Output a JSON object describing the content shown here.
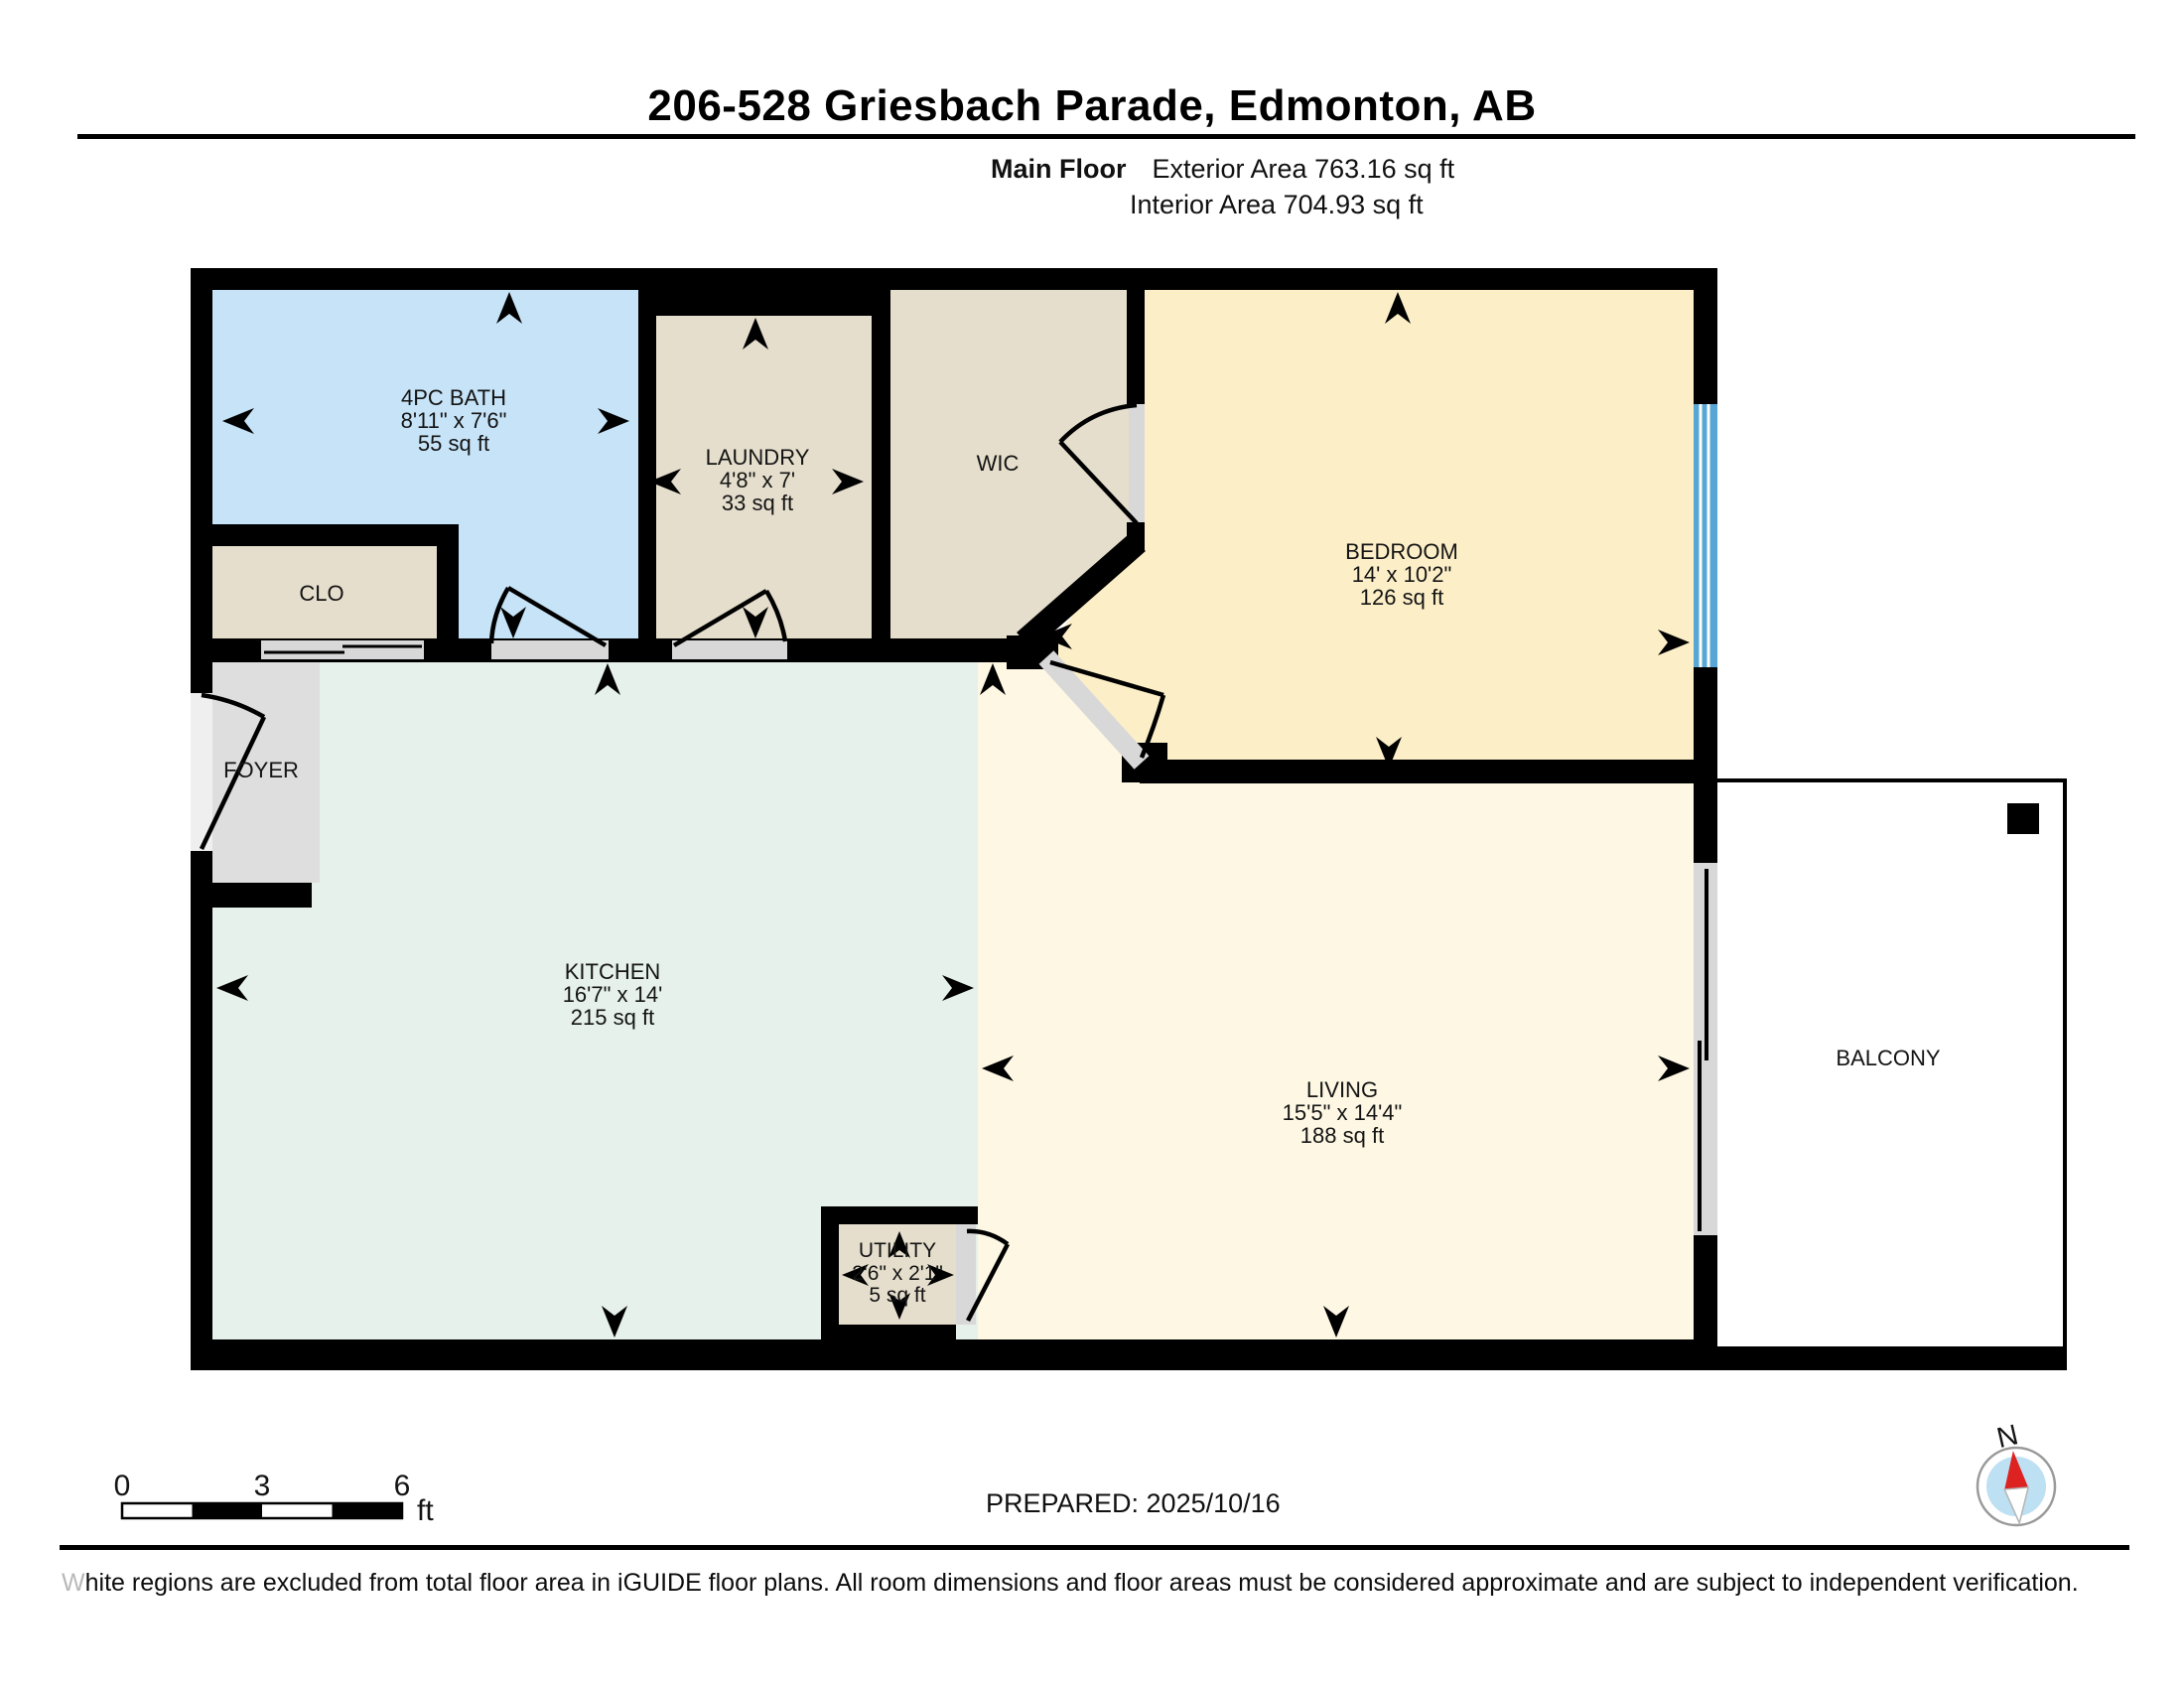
{
  "header": {
    "title": "206-528 Griesbach Parade, Edmonton, AB",
    "floor_label": "Main Floor",
    "exterior_area": "Exterior Area 763.16 sq ft",
    "interior_area": "Interior Area 704.93 sq ft"
  },
  "rooms": {
    "bath": {
      "name": "4PC BATH",
      "dims": "8'11\" x 7'6\"",
      "area": "55 sq ft"
    },
    "laundry": {
      "name": "LAUNDRY",
      "dims": "4'8\" x 7'",
      "area": "33 sq ft"
    },
    "wic": {
      "name": "WIC"
    },
    "bedroom": {
      "name": "BEDROOM",
      "dims": "14' x 10'2\"",
      "area": "126 sq ft"
    },
    "clo": {
      "name": "CLO"
    },
    "foyer": {
      "name": "FOYER"
    },
    "kitchen": {
      "name": "KITCHEN",
      "dims": "16'7\" x 14'",
      "area": "215 sq ft"
    },
    "living": {
      "name": "LIVING",
      "dims": "15'5\" x 14'4\"",
      "area": "188 sq ft"
    },
    "utility": {
      "name": "UTILITY",
      "dims": "2'6\" x 2'1\"",
      "area": "5 sq ft"
    },
    "balcony": {
      "name": "BALCONY"
    }
  },
  "scale_bar": {
    "start": "0",
    "mid": "3",
    "end": "6",
    "unit": "ft"
  },
  "footer": {
    "prepared": "PREPARED: 2025/10/16",
    "disclaimer": "White regions are excluded from total floor area in iGUIDE floor plans. All room dimensions and floor areas must be considered approximate and are subject to independent verification."
  },
  "compass": {
    "north_label": "N"
  },
  "colors": {
    "wall": "#000000",
    "bath_fill": "#C6E3F7",
    "tan_fill": "#E5DECC",
    "bedroom_fill": "#FCEFC8",
    "living_fill": "#FDF7E3",
    "kitchen_fill": "#E5F1EA",
    "foyer_fill": "#DEDEDE",
    "door_opening": "#D8D8D8",
    "window_blue": "#57A7D6",
    "compass_red": "#DD2222",
    "compass_blue": "#BDE0F2"
  }
}
